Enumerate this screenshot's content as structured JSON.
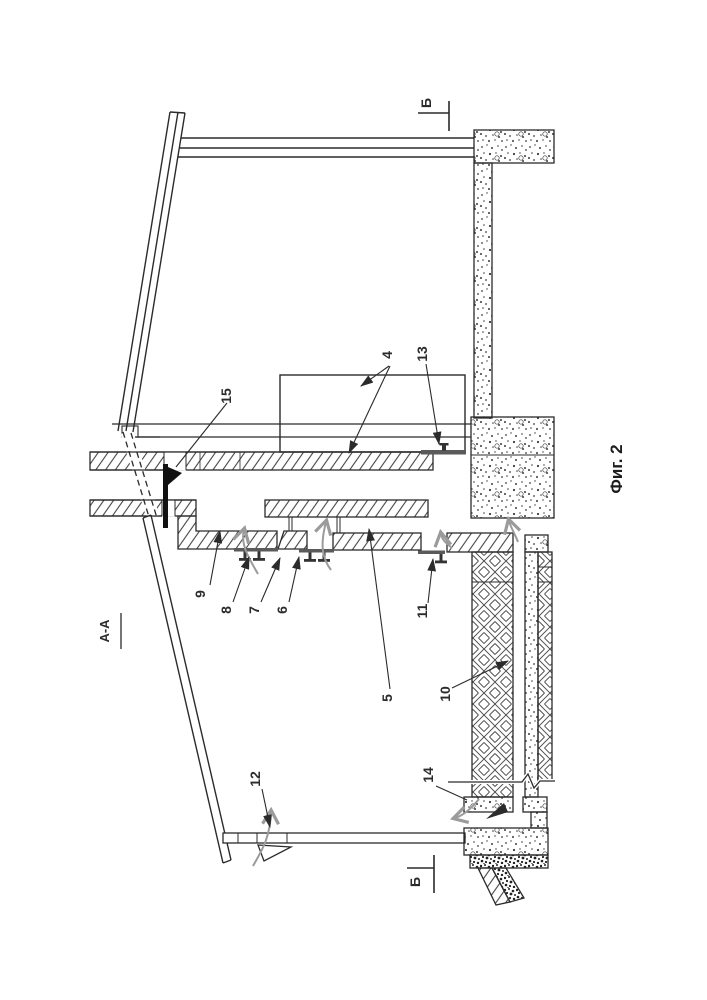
{
  "figure": {
    "type": "patent-sectional-drawing",
    "caption": "Фиг. 2",
    "view_label": "А-А"
  },
  "section_markers": {
    "top": "Б",
    "bottom": "Б"
  },
  "part_labels": [
    {
      "num": "4"
    },
    {
      "num": "5"
    },
    {
      "num": "6"
    },
    {
      "num": "7"
    },
    {
      "num": "8"
    },
    {
      "num": "9"
    },
    {
      "num": "10"
    },
    {
      "num": "11"
    },
    {
      "num": "12"
    },
    {
      "num": "13"
    },
    {
      "num": "14"
    },
    {
      "num": "15"
    }
  ],
  "colors": {
    "line": "#2b2b2b",
    "hatch": "#454545",
    "flow_arrow": "#9b9b9b",
    "plate": "#5a5a5a",
    "background": "#ffffff"
  }
}
